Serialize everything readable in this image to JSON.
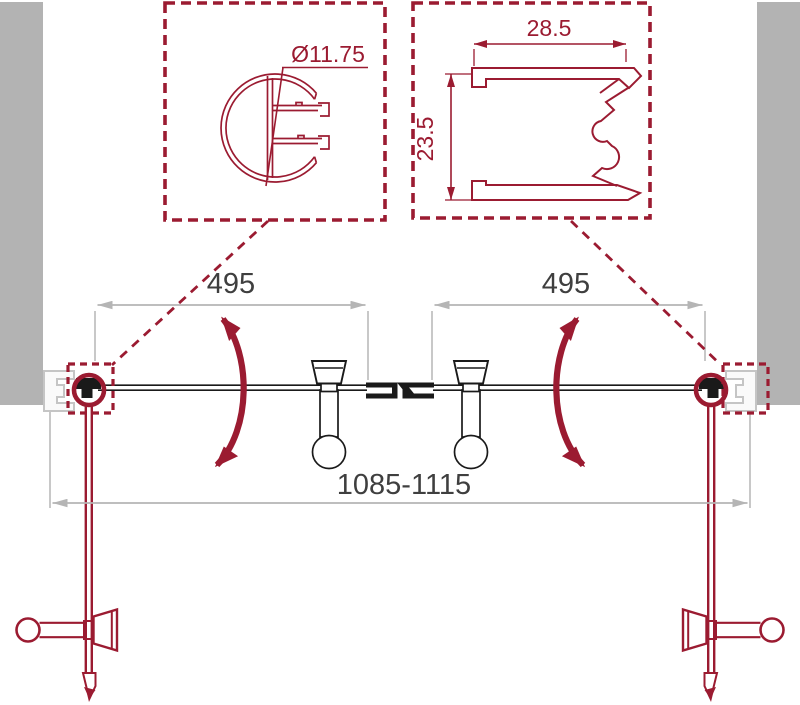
{
  "diagram_title": "double-swing-shower-door-installation-diagram",
  "colors": {
    "accent": "#9b1b31",
    "wall": "#b3b3b3",
    "profile_outline": "#c5c5c5",
    "dim_line": "#b5b5b5",
    "dim_text": "#3f3f3f",
    "door_line": "#1a1a1a"
  },
  "dimensions": {
    "knob_profile_diameter": "Ø11.75",
    "wall_profile_width": "28.5",
    "wall_profile_height": "23.5",
    "left_door_width": "495",
    "right_door_width": "495",
    "overall_width_range": "1085-1115"
  }
}
